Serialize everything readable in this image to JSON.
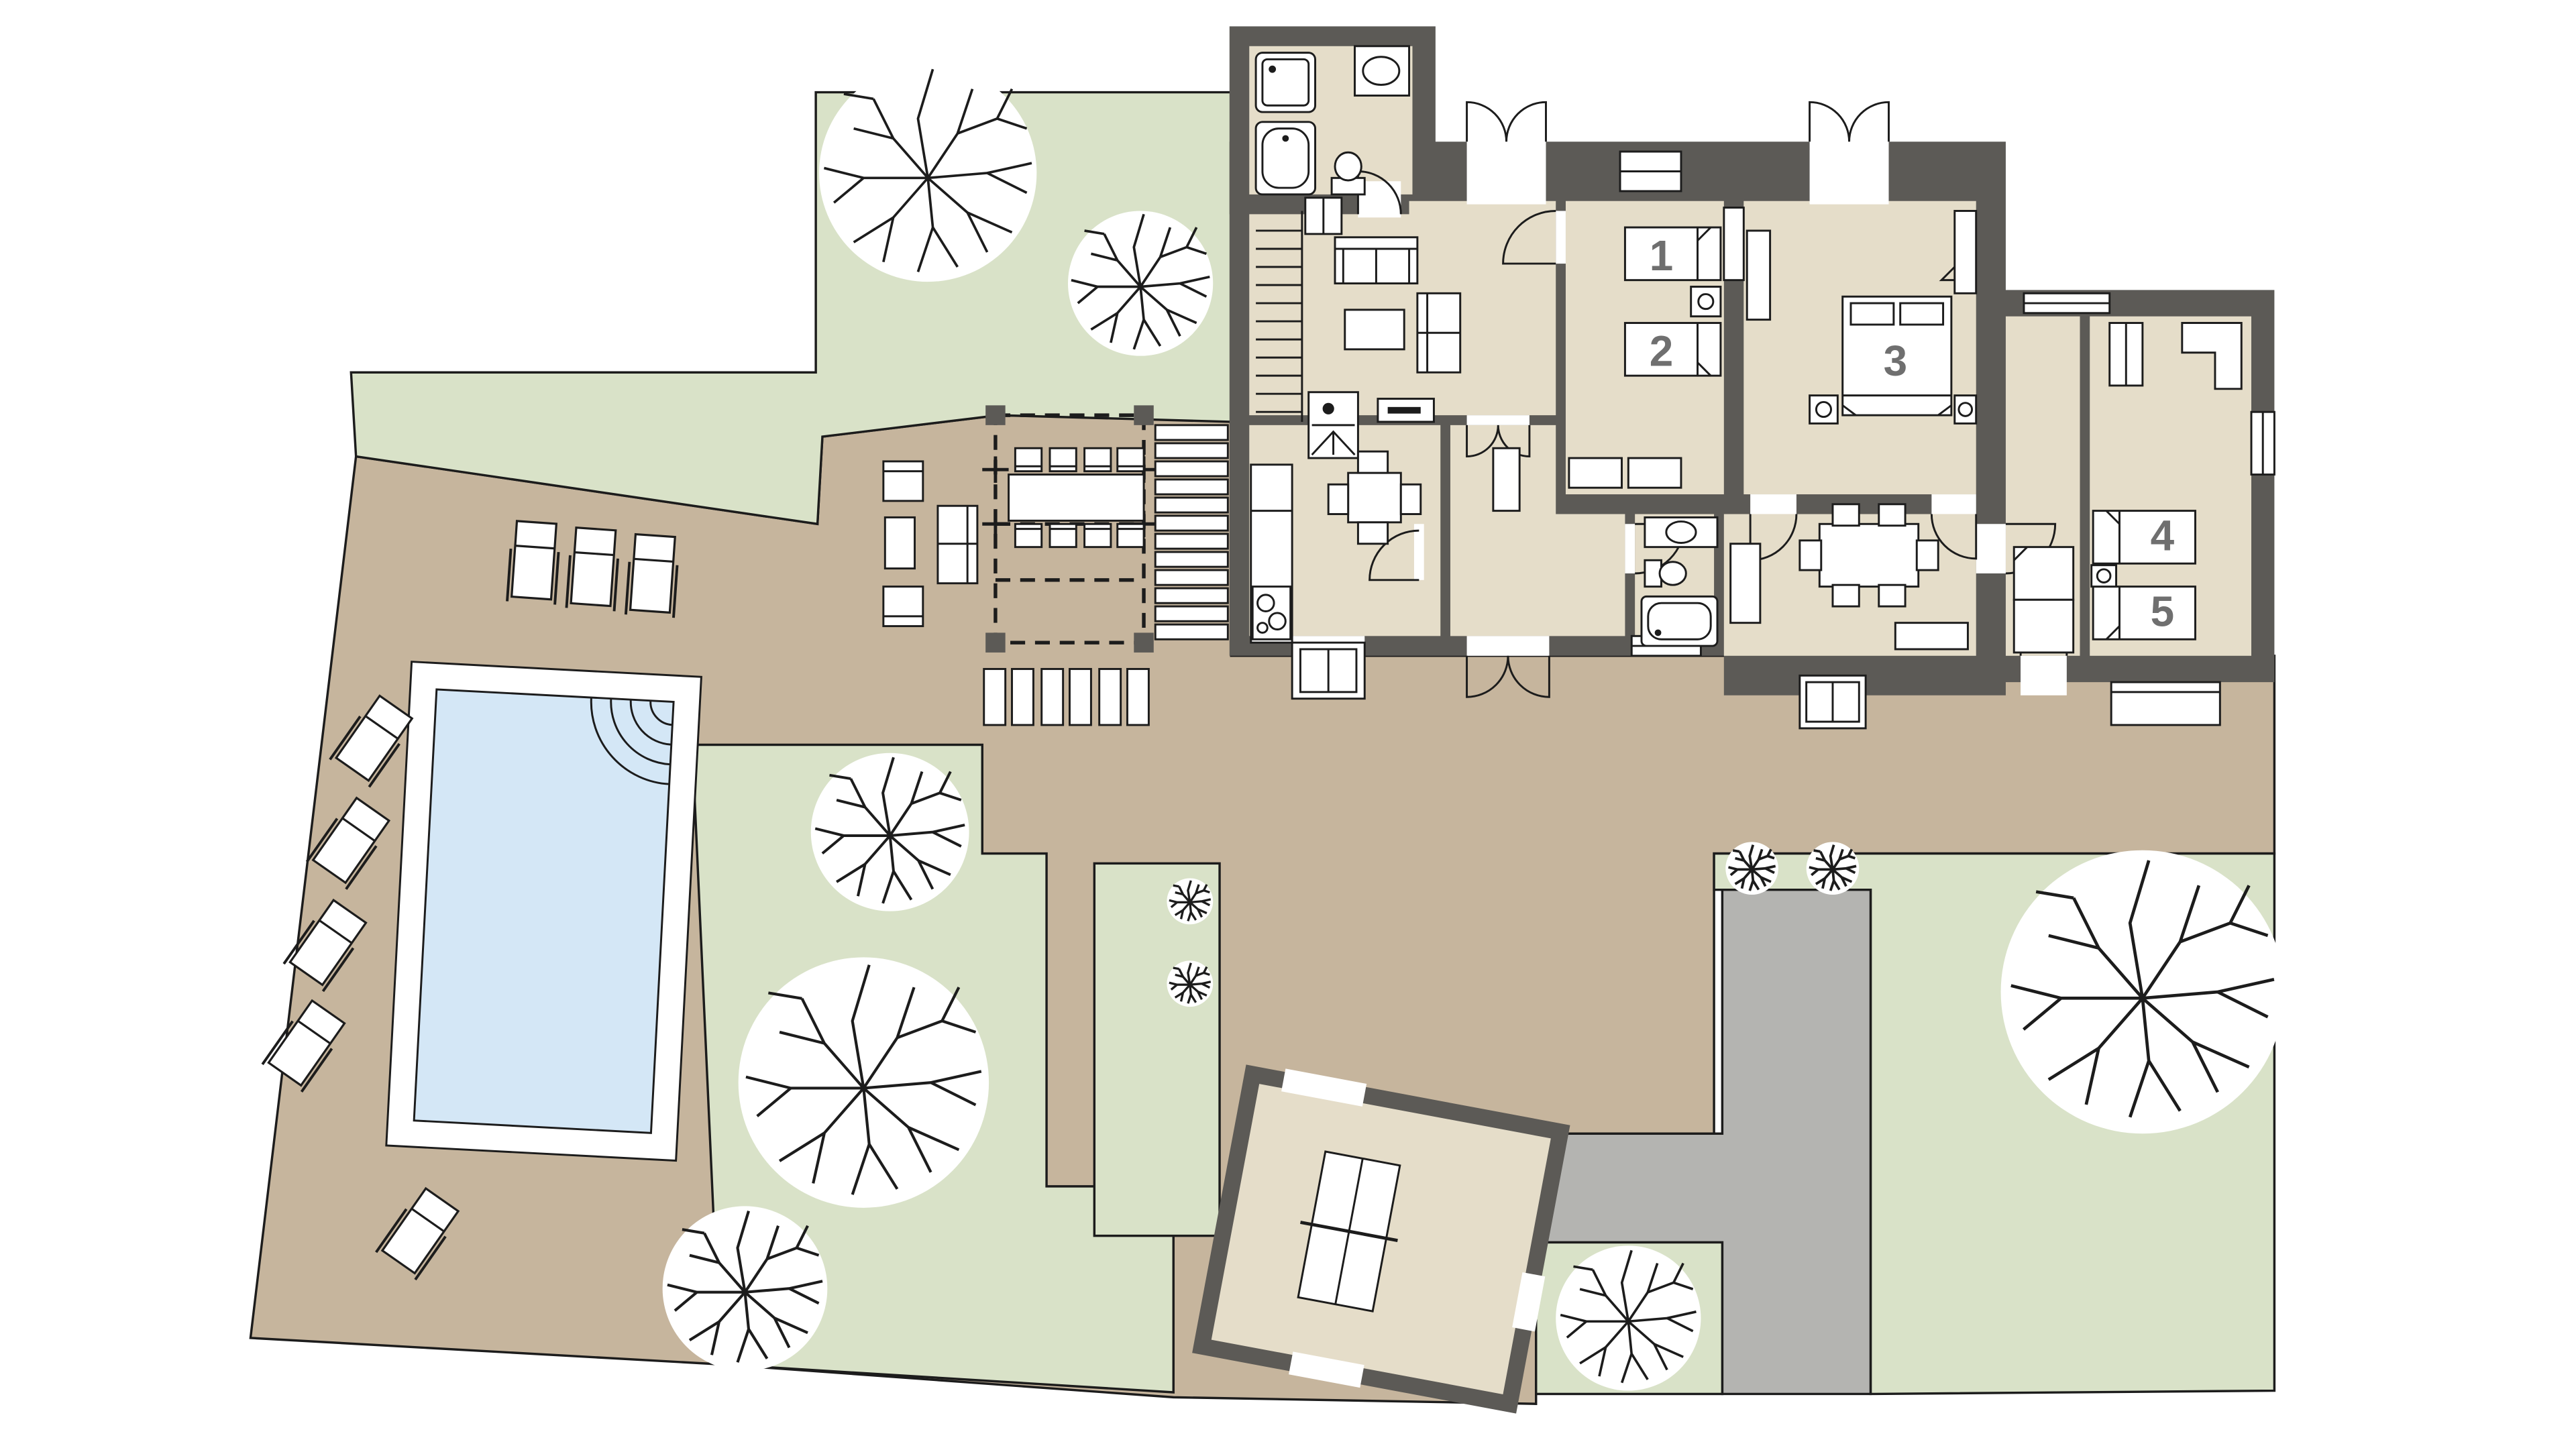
{
  "rooms": [
    {
      "number": "1",
      "name": "bedroom-1"
    },
    {
      "number": "2",
      "name": "bedroom-2"
    },
    {
      "number": "3",
      "name": "bedroom-3"
    },
    {
      "number": "4",
      "name": "bedroom-4"
    },
    {
      "number": "5",
      "name": "bedroom-5"
    }
  ],
  "colors": {
    "wall": "#5c5a56",
    "floor": "#e5ddc9",
    "terrace": "#c6b59d",
    "grass": "#d9e2c8",
    "paving": "#b4b4b1",
    "pool_water": "#d4e7f6",
    "outline": "#1c1c1c",
    "label": "#6f6f6f",
    "white": "#ffffff"
  }
}
